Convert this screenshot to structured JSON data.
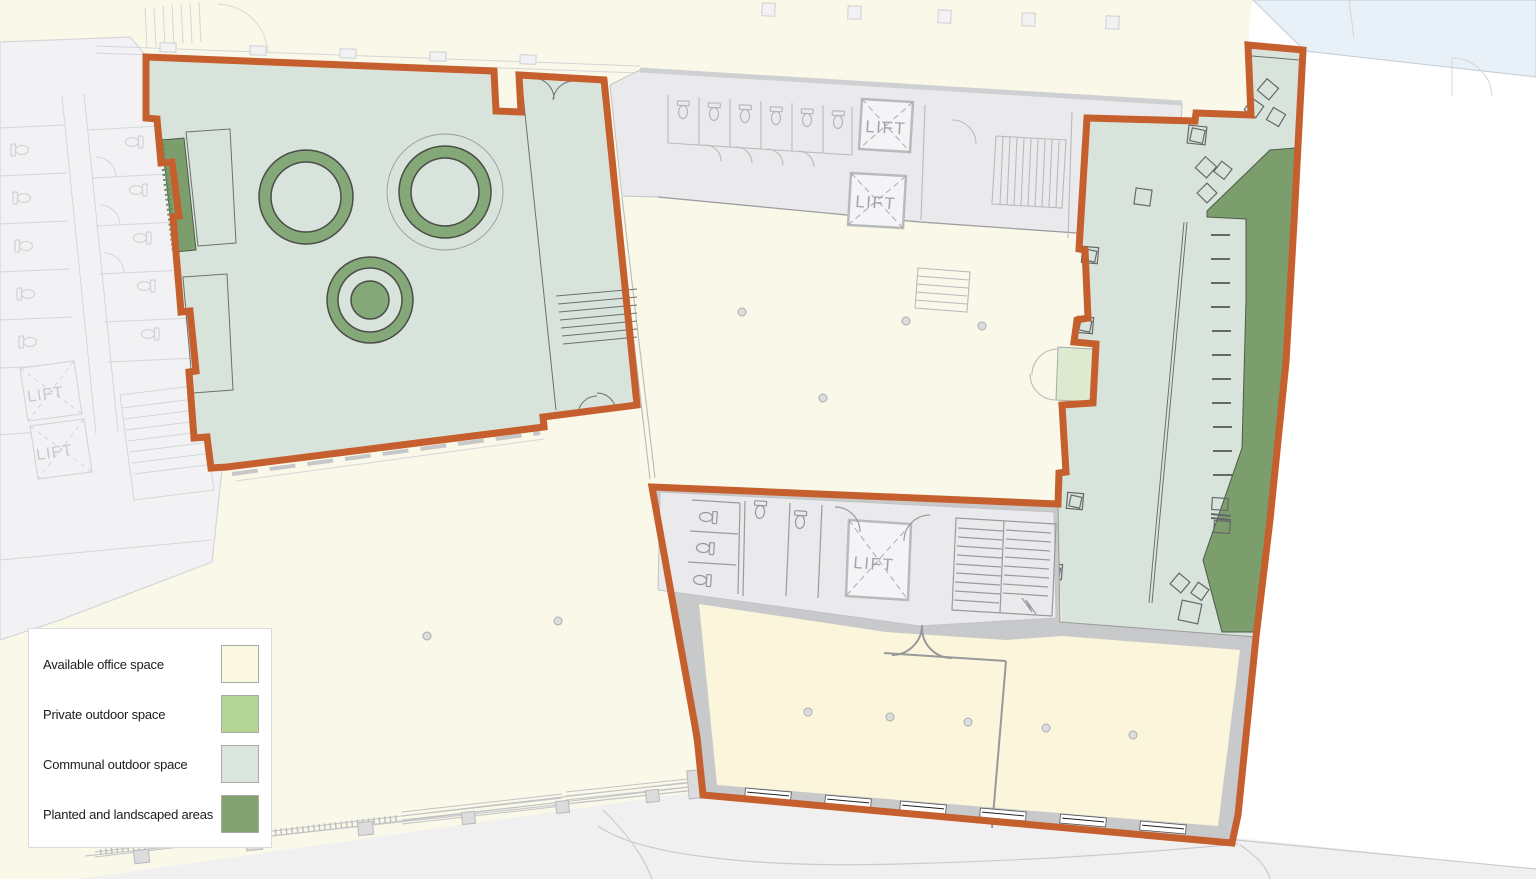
{
  "labels": {
    "lift": "LIFT"
  },
  "legend": {
    "items": [
      {
        "id": "available-office-space",
        "label": "Available office space",
        "color": "#FAF8E1"
      },
      {
        "id": "private-outdoor-space",
        "label": "Private outdoor space",
        "color": "#B5D596"
      },
      {
        "id": "communal-outdoor-space",
        "label": "Communal outdoor space",
        "color": "#D9E6DD"
      },
      {
        "id": "planted-and-landscaped-areas",
        "label": "Planted and landscaped areas",
        "color": "#82A371"
      }
    ]
  },
  "colors": {
    "cream": "#FAF8E8",
    "office": "#FBF5DB",
    "communal": "#D8E4DB",
    "private-patch": "#DEEACF",
    "planted": "#7C9E6C",
    "ring": "#85A878",
    "orange": "#C65F2E",
    "water": "#E8F1F8",
    "street": "#F0F0F1",
    "band": "#C8C9CB",
    "core": "#EAEAEC",
    "faint-fill": "#F2F2F4",
    "faint-line": "#D5D6D8",
    "wall": "#9A9B9D",
    "mid": "#B9BABC",
    "lift-text": "#A3A5A7",
    "legend-border": "#DCDCDC",
    "legend-text": "#1C1C1C"
  }
}
